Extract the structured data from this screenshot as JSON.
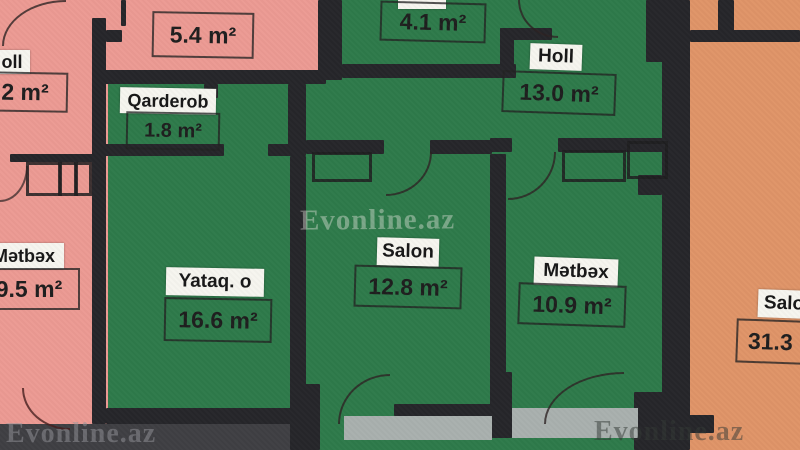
{
  "plan": {
    "watermarks": {
      "center": "Evonline.az",
      "bottom_left": "Evonline.az",
      "bottom_right": "Evonline.az"
    },
    "rooms": {
      "neighbor_left_holl": {
        "name_partial": "oll",
        "area_partial": "2 m²"
      },
      "neighbor_left_metbex": {
        "name": "Mətbəx",
        "area": "9.5 m²"
      },
      "neighbor_top_room": {
        "area": "5.4 m²"
      },
      "qarderob": {
        "name": "Qarderob",
        "area": "1.8 m²"
      },
      "small_room": {
        "area": "4.1 m²"
      },
      "holl": {
        "name": "Holl",
        "area": "13.0 m²"
      },
      "yataq": {
        "name": "Yataq. o",
        "area": "16.6 m²"
      },
      "salon": {
        "name": "Salon",
        "area": "12.8 m²"
      },
      "metbex": {
        "name": "Mətbəx",
        "area": "10.9 m²"
      },
      "neighbor_right_salon": {
        "name_partial": "Salo",
        "area_partial": "31.3"
      }
    },
    "colors": {
      "apartment_green": "#2e7a4a",
      "neighbor_pink": "#ec9a93",
      "neighbor_orange": "#df9468",
      "wall_dark": "#26262a",
      "balcony_gray": "#a9b0ae",
      "label_bg": "#f6f5ef"
    }
  }
}
